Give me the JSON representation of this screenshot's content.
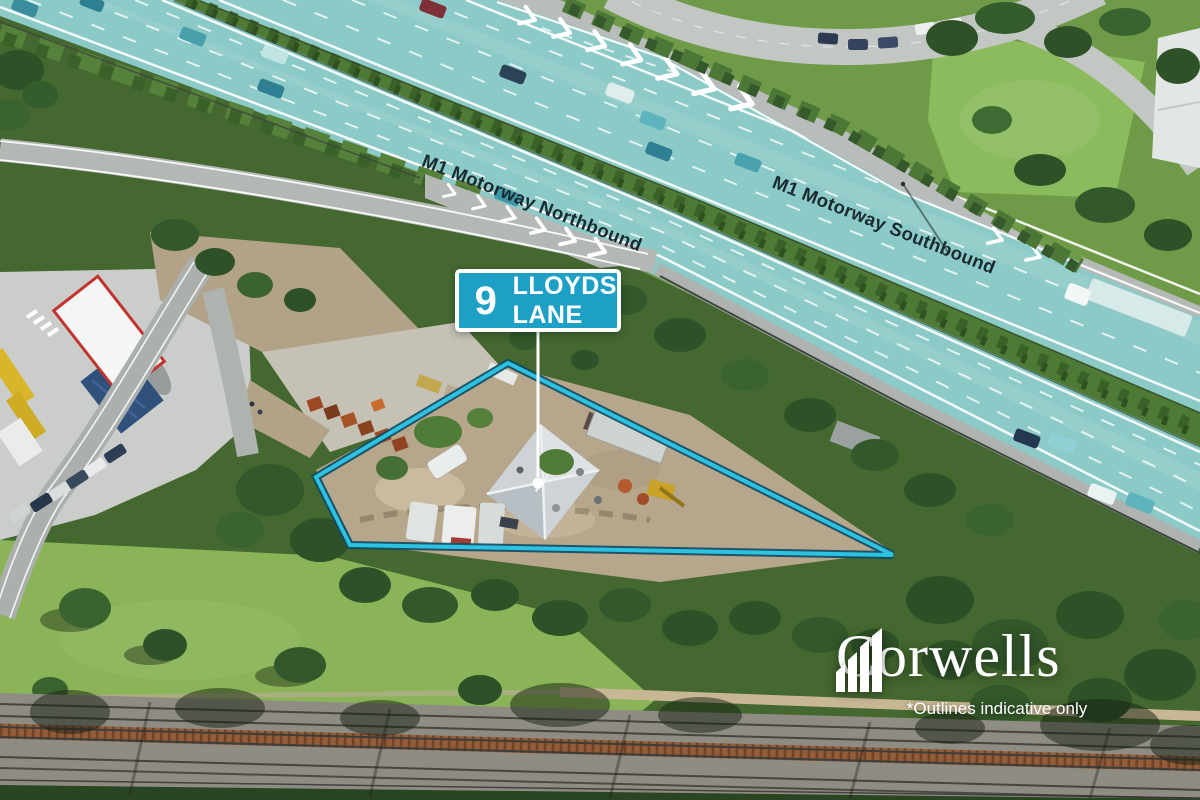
{
  "sign": {
    "number": "9",
    "street_line1": "LLOYDS",
    "street_line2": "LANE"
  },
  "road_labels": {
    "northbound": "M1 Motorway Northbound",
    "southbound": "M1 Motorway Southbound"
  },
  "branding": {
    "logo_text": "Corwells",
    "logo_icon": "skyline-bars-icon",
    "disclaimer": "*Outlines indicative only"
  },
  "colors": {
    "sign_teal": "#1d9fc6",
    "outline_teal": "#2cc2e2",
    "outline_edge": "#0f4a63",
    "motorway_tint": "#8ccac7",
    "label_text": "#1a2a32",
    "overlay_white": "#ffffff"
  }
}
